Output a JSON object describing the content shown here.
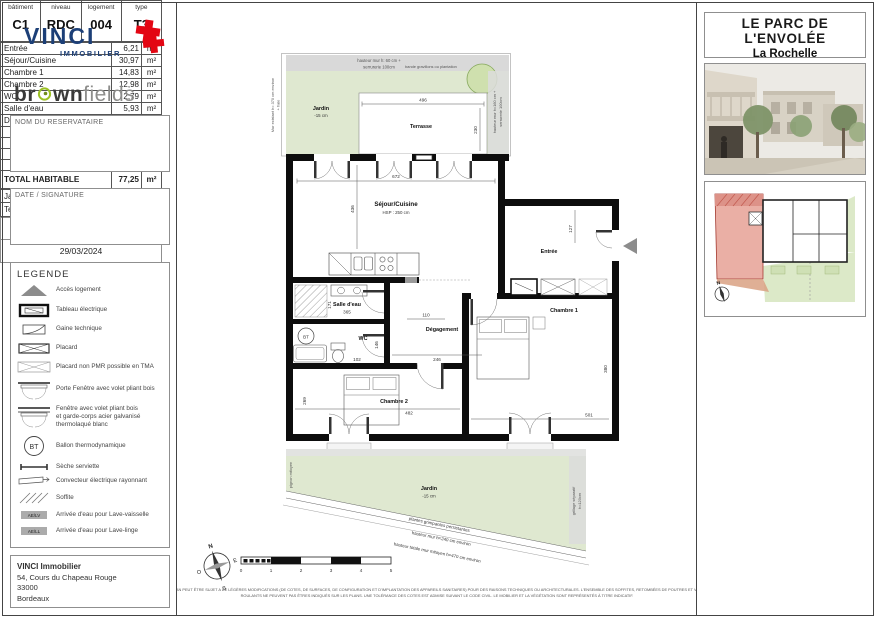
{
  "branding": {
    "vinci": {
      "name": "VINCI",
      "division": "IMMOBILIER"
    },
    "brownfields": {
      "p1": "br",
      "p2": "wn",
      "p3": "fields"
    }
  },
  "left_panel": {
    "reservataire_label": "NOM DU RESERVATAIRE",
    "date_signature_label": "DATE / SIGNATURE",
    "legend": {
      "title": "LEGENDE",
      "items": [
        {
          "name": "acces-logement",
          "label": "Accès logement"
        },
        {
          "name": "tableau-electrique",
          "label": "Tableau électrique"
        },
        {
          "name": "gaine-technique",
          "label": "Gaine technique"
        },
        {
          "name": "placard",
          "label": "Placard"
        },
        {
          "name": "placard-non-pmr",
          "label": "Placard non PMR possible en TMA"
        },
        {
          "name": "porte-fenetre",
          "label": "Porte Fenêtre avec volet pliant bois"
        },
        {
          "name": "fenetre-garde-corps",
          "label": "Fenêtre avec volet pliant bois\net garde-corps acier galvanisé\nthermolaqué blanc"
        },
        {
          "name": "ballon-thermodynamique",
          "label": "Ballon thermodynamique",
          "badge": "BT"
        },
        {
          "name": "seche-serviette",
          "label": "Sèche serviette"
        },
        {
          "name": "convecteur",
          "label": "Convecteur électrique rayonnant"
        },
        {
          "name": "soffite",
          "label": "Soffite"
        },
        {
          "name": "arrivee-eau-lv",
          "label": "Arrivée d'eau pour Lave-vaisselle",
          "badge": "AE/LV"
        },
        {
          "name": "arrivee-eau-ll",
          "label": "Arrivée d'eau pour Lave-linge",
          "badge": "AE/LL"
        }
      ]
    },
    "address": {
      "company": "VINCI Immobilier",
      "street": "54, Cours du Chapeau Rouge",
      "postal": "33000",
      "city": "Bordeaux"
    }
  },
  "plan": {
    "mur_existant_l1": "Mur existant h= 370 cm environ",
    "mur_existant_l2": "+ haie",
    "mur_top_l1": "hauteur mur h: 60 cm +",
    "mur_top_l2": "serrurerie 100cm",
    "bande_gravillons": "bande gravillons ou plantation",
    "mur_droit_l1": "hauteur mur h=160 cm +",
    "mur_droit_l2": "serrurerie 100cm",
    "jardin_haut": {
      "label": "Jardin",
      "niveau": "-15 cm"
    },
    "terrasse": {
      "label": "Terrasse",
      "largeur": "496",
      "profondeur": "230"
    },
    "sejour": {
      "label": "Séjour/Cuisine",
      "hsp": "HSP : 250 cm",
      "largeur": "672",
      "profondeur": "436"
    },
    "salle_eau": {
      "label": "Salle d'eau",
      "largeur": "365",
      "profondeur": "171"
    },
    "wc": {
      "label": "WC",
      "largeur": "102",
      "profondeur": "146"
    },
    "degagement": {
      "label": "Dégagement",
      "largeur": "246",
      "largeur2": "110"
    },
    "entree": {
      "label": "Entrée",
      "profondeur": "127"
    },
    "chambre1": {
      "label": "Chambre 1",
      "largeur": "501",
      "profondeur": "380"
    },
    "chambre2": {
      "label": "Chambre 2",
      "largeur": "482",
      "profondeur": "269"
    },
    "bt": "BT",
    "jardin_bas": {
      "label": "Jardin",
      "niveau": "-15 cm",
      "note_plantes": "plantes grimpantes persistantes",
      "note_mur": "hauteur mur h=240 cm environ",
      "note_mur_total": "hauteur totale mur mitoyen h=470 cm environ"
    },
    "pignon": "pignon mitoyen",
    "grillage_l1": "grillage séparatif",
    "grillage_l2": "h=120cm",
    "compass": {
      "n": "N",
      "e": "E",
      "s": "S",
      "o": "O"
    },
    "scale": [
      "0",
      "1",
      "2",
      "3",
      "4",
      "5"
    ]
  },
  "right_panel": {
    "title_line1": "LE PARC DE",
    "title_line2": "L'ENVOLÉE",
    "subtitle": "La Rochelle",
    "unit_table": {
      "cols": [
        {
          "h": "bâtiment",
          "v": "C1"
        },
        {
          "h": "niveau",
          "v": "RDC"
        },
        {
          "h": "logement",
          "v": "004"
        },
        {
          "h": "type",
          "v": "T3"
        }
      ]
    },
    "rooms": [
      {
        "label": "Entrée",
        "area": "6,21"
      },
      {
        "label": "Séjour/Cuisine",
        "area": "30,97"
      },
      {
        "label": "Chambre 1",
        "area": "14,83"
      },
      {
        "label": "Chambre 2",
        "area": "12,98"
      },
      {
        "label": "WC",
        "area": "2,79"
      },
      {
        "label": "Salle d'eau",
        "area": "5,93"
      },
      {
        "label": "Dégagement",
        "area": "3,54"
      }
    ],
    "unit": "m²",
    "total": {
      "label": "TOTAL HABITABLE",
      "area": "77,25"
    },
    "outdoor": [
      {
        "label": "Jardin",
        "area": "44,44"
      },
      {
        "label": "Terrasse",
        "area": "11,41"
      }
    ],
    "revision": {
      "indice": "Indice A",
      "date": "29/03/2024"
    }
  },
  "footer": {
    "disclaimer_line1": "CE PLAN PEUT ÊTRE SUJET A DE LÉGÈRES MODIFICATIONS (DE COTES, DE SURFACES, DE CONFIGURATION ET D'IMPLANTATION DES APPAREILS SANITAIRES) POUR DES RAISONS TECHNIQUES OU ARCHITECTURALES. L'ENSEMBLE DES SOFFITES, RETOMBÉES DE POUTRES ET VOLETS",
    "disclaimer_line2": "ROULANTS NE PEUVENT PAS ÊTRES INDIQUÉS SUR LES PLANS. UNE TOLÉRANCE DES COTES EST ADMISE SUIVANT LE CODE CIVIL. LE MOBILIER ET LA VÉGÉTATION SONT REPRÉSENTÉS À TITRE INDICATIF."
  }
}
